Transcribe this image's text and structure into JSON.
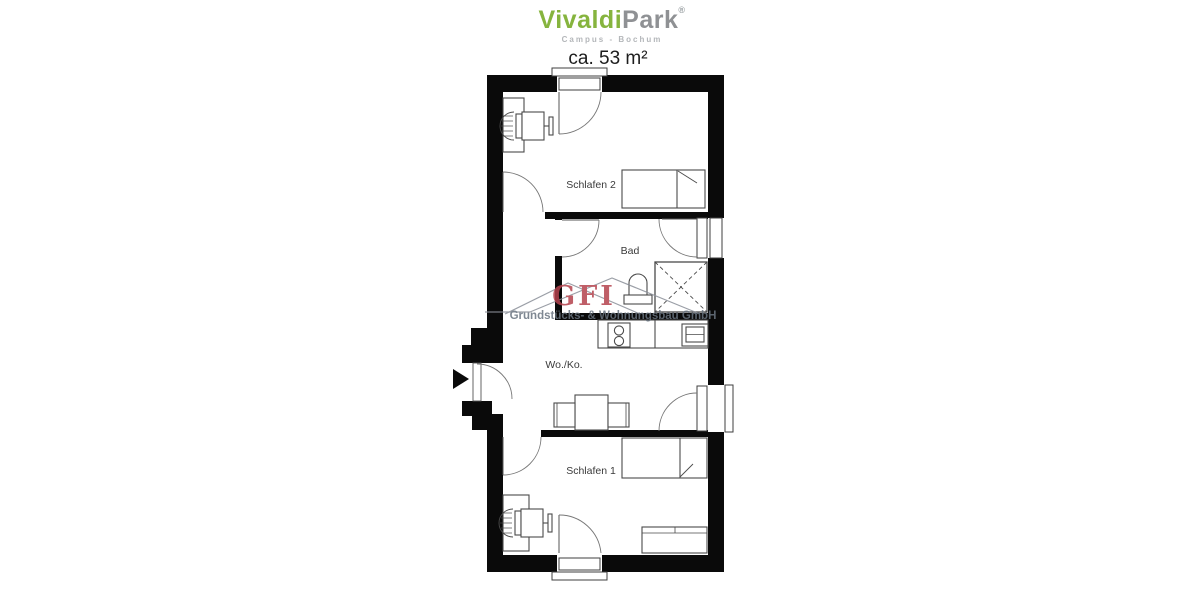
{
  "brand": {
    "name_primary": "Vivaldi",
    "name_secondary": "Park",
    "registered_mark": "®",
    "subtitle": "Campus - Bochum",
    "color_primary": "#86b43e",
    "color_secondary": "#8f9194"
  },
  "floor_plan": {
    "area_label": "ca. 53 m²",
    "rooms": [
      {
        "id": "schlafen-2",
        "label": "Schlafen 2"
      },
      {
        "id": "bad",
        "label": "Bad"
      },
      {
        "id": "wohnen-kochen",
        "label": "Wo./Ko."
      },
      {
        "id": "schlafen-1",
        "label": "Schlafen 1"
      }
    ],
    "wall_color": "#0a0a0a",
    "furniture_line_color": "#4a4a4a"
  },
  "watermark": {
    "logo_text": "GFI",
    "company_name": "Grundstücks- & Wohnungsbau GmbH",
    "logo_color": "#b4424d",
    "company_color": "#68737f"
  }
}
